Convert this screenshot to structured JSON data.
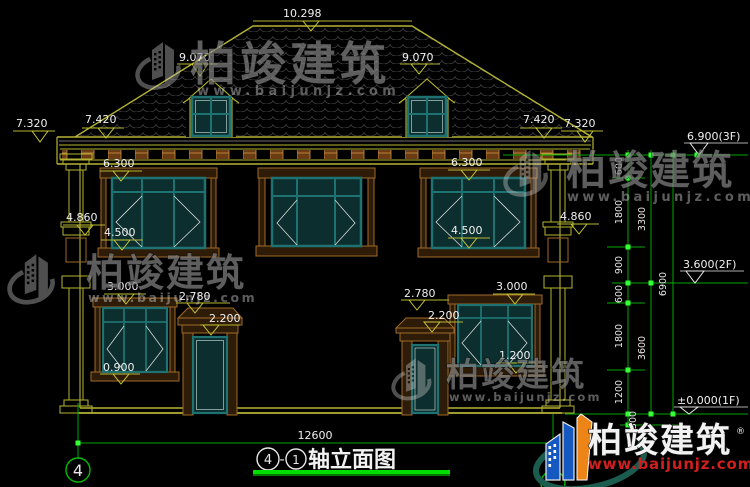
{
  "levels": {
    "ridge": "10.298",
    "roof_l": "9.070",
    "roof_r": "9.070",
    "eave_outer_l": "7.320",
    "eave_inner_l": "7.420",
    "eave_inner_r": "7.420",
    "eave_outer_r": "7.320",
    "w2f_head_l": "6.300",
    "w2f_head_r": "6.300",
    "pilaster_l": "4.860",
    "pilaster_r": "4.860",
    "w2f_sill_l": "4.500",
    "w2f_sill_r": "4.500",
    "w1f_head_l": "3.000",
    "w1f_head_r": "3.000",
    "canopy_l": "2.780",
    "canopy_r": "2.780",
    "door_l": "2.200",
    "door_r": "2.200",
    "w1f_sill_l": "0.900",
    "w1f_sill_r": "1.200"
  },
  "story": {
    "f3": "6.900(3F)",
    "f2": "3.600(2F)",
    "f1": "±0.000(1F)"
  },
  "chains": {
    "v1": [
      "600",
      "1800",
      "900",
      "600",
      "1800",
      "1200",
      "300"
    ],
    "v2": [
      "3300",
      "3600"
    ],
    "v3": [
      "6900"
    ]
  },
  "bottom": {
    "overall_dim": "12600",
    "axis_a": "4",
    "dash": "-",
    "axis_b": "1",
    "title": "轴立面图"
  },
  "axis": {
    "bubble": "4"
  },
  "wm": {
    "brand": "柏竣建筑",
    "url": "www.baijunjz.com"
  },
  "logo": {
    "brand": "柏竣建筑",
    "url": "www.baijunjz.com",
    "reg": "®"
  }
}
